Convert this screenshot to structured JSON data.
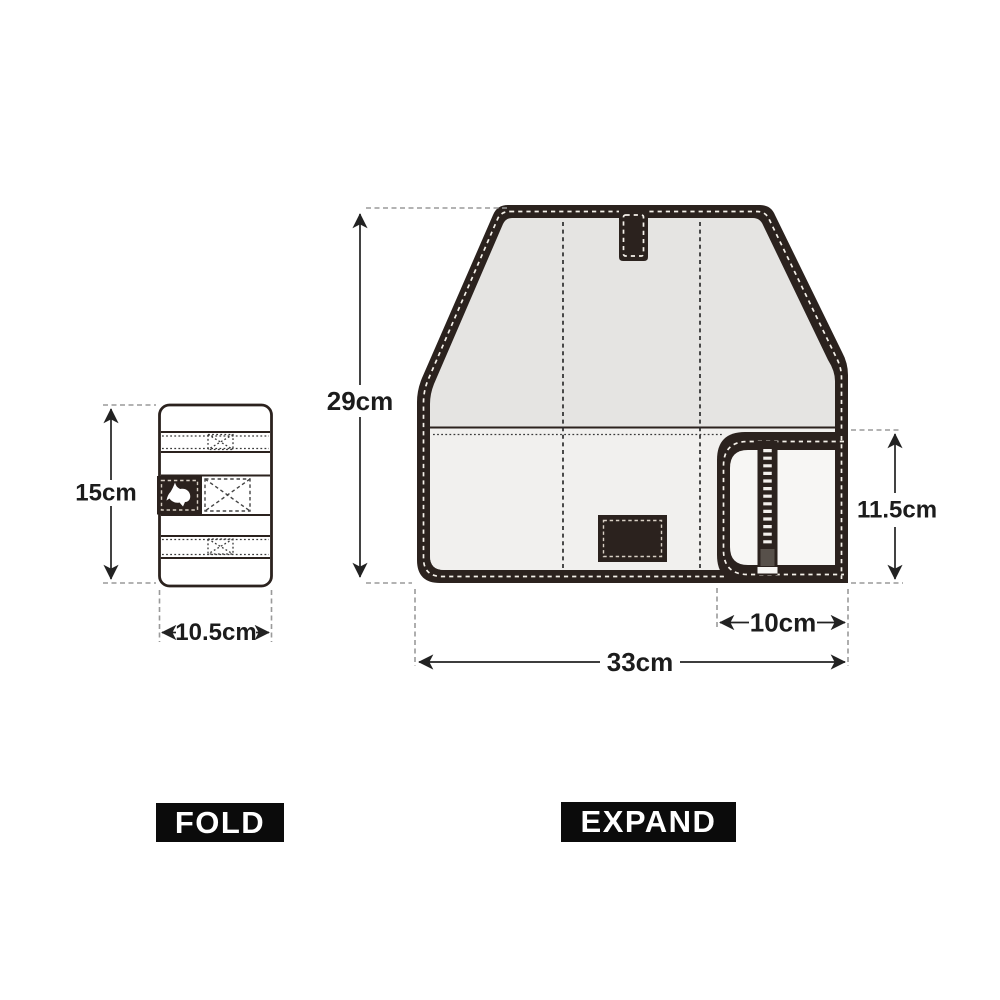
{
  "colors": {
    "background": "#ffffff",
    "fabric_dark": "#2b221e",
    "flap_fill": "#e5e4e2",
    "body_fill": "#f1f0ee",
    "pocket_fill": "#f7f6f4",
    "stitch_light": "#f5f1ea",
    "patch_stitch": "#d8cfc4",
    "dimension_line": "#222222",
    "extension_line": "#9a9a9a",
    "caption_bg": "#0b0b0b",
    "caption_text": "#ffffff"
  },
  "fold_view": {
    "caption": "FOLD",
    "height_label": "15cm",
    "width_label": "10.5cm",
    "logo_icon": "rhino"
  },
  "expand_view": {
    "caption": "EXPAND",
    "height_label": "29cm",
    "width_label": "33cm",
    "pocket_width_label": "10cm",
    "pocket_height_label": "11.5cm"
  }
}
